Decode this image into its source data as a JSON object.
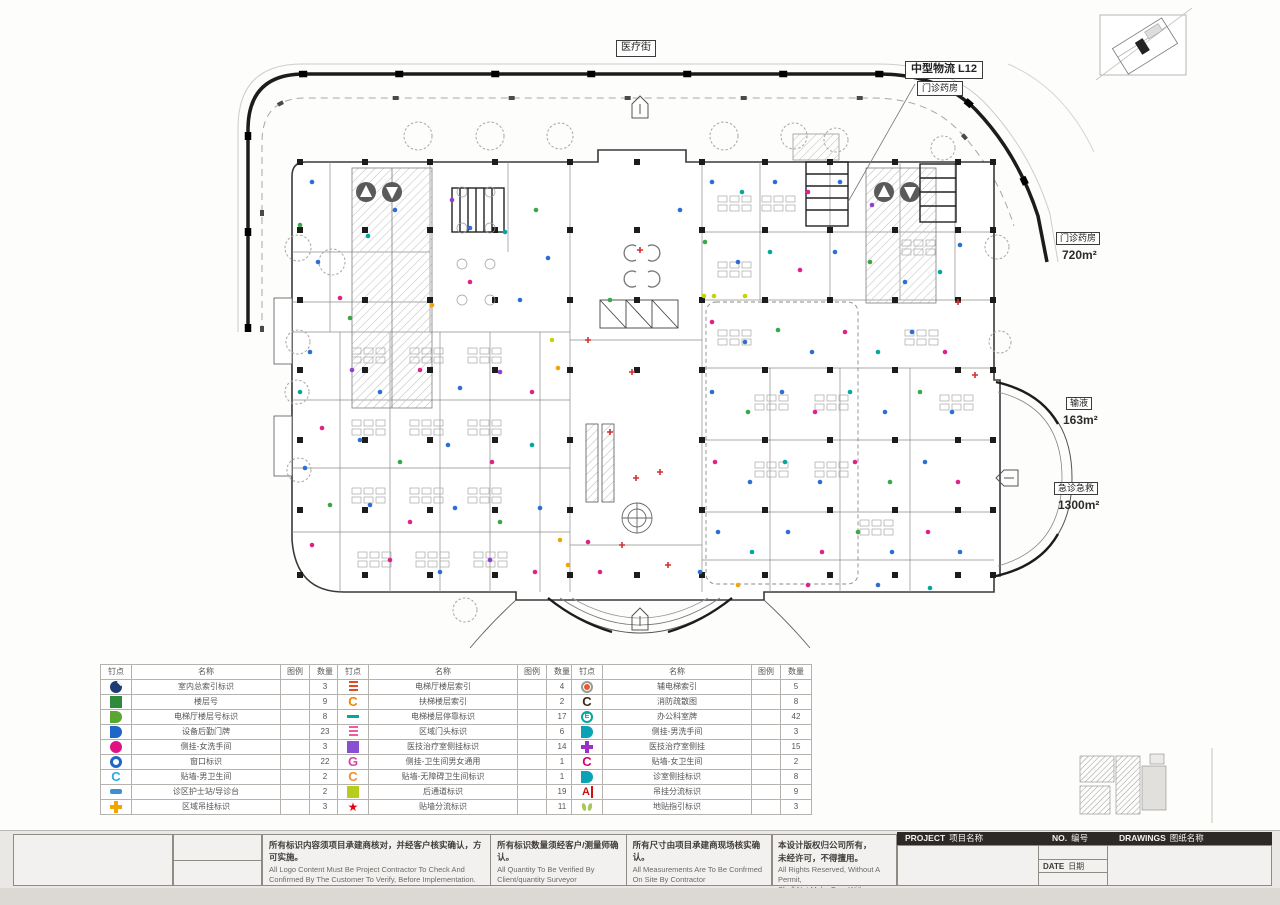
{
  "plan": {
    "street_label": "医疗街",
    "logistics_label": "中型物流  L12",
    "logistics_sub": "门诊药房",
    "area_labels": [
      {
        "name": "门诊药房",
        "area": "720m²"
      },
      {
        "name": "输液",
        "area": "163m²"
      },
      {
        "name": "急诊急救",
        "area": "1300m²"
      }
    ],
    "marker_colors": [
      "#2b6fd4",
      "#e0218a",
      "#3aa746",
      "#9040d0",
      "#d43030",
      "#f0a500",
      "#00a99d",
      "#29abe2",
      "#c3d600"
    ],
    "markers": [
      [
        312,
        182,
        0
      ],
      [
        300,
        225,
        2
      ],
      [
        318,
        262,
        0
      ],
      [
        340,
        298,
        1
      ],
      [
        368,
        236,
        6
      ],
      [
        395,
        210,
        0
      ],
      [
        452,
        200,
        3
      ],
      [
        470,
        228,
        0
      ],
      [
        505,
        232,
        6
      ],
      [
        536,
        210,
        2
      ],
      [
        548,
        258,
        0
      ],
      [
        470,
        282,
        1
      ],
      [
        432,
        305,
        5
      ],
      [
        520,
        300,
        0
      ],
      [
        350,
        318,
        2
      ],
      [
        310,
        352,
        0
      ],
      [
        300,
        392,
        6
      ],
      [
        322,
        428,
        1
      ],
      [
        305,
        468,
        0
      ],
      [
        330,
        505,
        2
      ],
      [
        312,
        545,
        1
      ],
      [
        352,
        370,
        3
      ],
      [
        380,
        392,
        0
      ],
      [
        420,
        370,
        1
      ],
      [
        460,
        388,
        0
      ],
      [
        500,
        372,
        3
      ],
      [
        532,
        392,
        1
      ],
      [
        360,
        440,
        0
      ],
      [
        400,
        462,
        2
      ],
      [
        448,
        445,
        0
      ],
      [
        492,
        462,
        1
      ],
      [
        532,
        445,
        6
      ],
      [
        370,
        505,
        0
      ],
      [
        410,
        522,
        1
      ],
      [
        455,
        508,
        0
      ],
      [
        500,
        522,
        2
      ],
      [
        540,
        508,
        0
      ],
      [
        390,
        560,
        1
      ],
      [
        440,
        572,
        0
      ],
      [
        490,
        560,
        3
      ],
      [
        535,
        572,
        1
      ],
      [
        560,
        540,
        5
      ],
      [
        558,
        368,
        5
      ],
      [
        552,
        340,
        8
      ],
      [
        588,
        340,
        4
      ],
      [
        632,
        372,
        4
      ],
      [
        610,
        432,
        4
      ],
      [
        660,
        472,
        4
      ],
      [
        588,
        542,
        1
      ],
      [
        640,
        250,
        4
      ],
      [
        680,
        210,
        0
      ],
      [
        622,
        545,
        4
      ],
      [
        636,
        478,
        4
      ],
      [
        610,
        300,
        2
      ],
      [
        704,
        296,
        8
      ],
      [
        714,
        296,
        8
      ],
      [
        745,
        296,
        8
      ],
      [
        568,
        565,
        5
      ],
      [
        600,
        572,
        1
      ],
      [
        700,
        572,
        0
      ],
      [
        668,
        565,
        4
      ],
      [
        712,
        182,
        0
      ],
      [
        742,
        192,
        6
      ],
      [
        775,
        182,
        0
      ],
      [
        808,
        192,
        1
      ],
      [
        840,
        182,
        0
      ],
      [
        872,
        205,
        3
      ],
      [
        705,
        242,
        2
      ],
      [
        738,
        262,
        0
      ],
      [
        770,
        252,
        6
      ],
      [
        800,
        270,
        1
      ],
      [
        835,
        252,
        0
      ],
      [
        870,
        262,
        2
      ],
      [
        905,
        282,
        0
      ],
      [
        940,
        272,
        6
      ],
      [
        960,
        245,
        0
      ],
      [
        712,
        322,
        1
      ],
      [
        745,
        342,
        0
      ],
      [
        778,
        330,
        2
      ],
      [
        812,
        352,
        0
      ],
      [
        845,
        332,
        1
      ],
      [
        878,
        352,
        6
      ],
      [
        912,
        332,
        0
      ],
      [
        945,
        352,
        1
      ],
      [
        712,
        392,
        0
      ],
      [
        748,
        412,
        2
      ],
      [
        782,
        392,
        0
      ],
      [
        815,
        412,
        1
      ],
      [
        850,
        392,
        6
      ],
      [
        885,
        412,
        0
      ],
      [
        920,
        392,
        2
      ],
      [
        952,
        412,
        0
      ],
      [
        715,
        462,
        1
      ],
      [
        750,
        482,
        0
      ],
      [
        785,
        462,
        6
      ],
      [
        820,
        482,
        0
      ],
      [
        855,
        462,
        1
      ],
      [
        890,
        482,
        2
      ],
      [
        925,
        462,
        0
      ],
      [
        958,
        482,
        1
      ],
      [
        718,
        532,
        0
      ],
      [
        752,
        552,
        6
      ],
      [
        788,
        532,
        0
      ],
      [
        822,
        552,
        1
      ],
      [
        858,
        532,
        2
      ],
      [
        892,
        552,
        0
      ],
      [
        928,
        532,
        1
      ],
      [
        960,
        552,
        0
      ],
      [
        738,
        585,
        5
      ],
      [
        808,
        585,
        1
      ],
      [
        878,
        585,
        0
      ],
      [
        930,
        588,
        6
      ],
      [
        975,
        375,
        4
      ],
      [
        958,
        302,
        4
      ]
    ]
  },
  "legend_tables": [
    {
      "headers": [
        "钉点",
        "名称",
        "图例",
        "数量"
      ],
      "rows": [
        {
          "icon": {
            "type": "nav",
            "color": "#1f3b73"
          },
          "name": "室内总索引标识",
          "qty": "3"
        },
        {
          "icon": {
            "type": "square",
            "color": "#2e8b3c"
          },
          "name": "楼层号",
          "qty": "9"
        },
        {
          "icon": {
            "type": "halfD",
            "color": "#5aa632"
          },
          "name": "电梯厅楼层号标识",
          "qty": "8"
        },
        {
          "icon": {
            "type": "halfD",
            "color": "#1e66c8"
          },
          "name": "设备后勤门牌",
          "qty": "23"
        },
        {
          "icon": {
            "type": "circle",
            "color": "#e01283"
          },
          "name": "侧挂-女洗手间",
          "qty": "3"
        },
        {
          "icon": {
            "type": "ring",
            "color": "#1e66c8"
          },
          "name": "窗口标识",
          "qty": "22"
        },
        {
          "icon": {
            "type": "C",
            "color": "#2da9e1"
          },
          "name": "贴墙-男卫生间",
          "qty": "2"
        },
        {
          "icon": {
            "type": "bar",
            "color": "#3f8fd2"
          },
          "name": "诊区护士站/导诊台",
          "qty": "2"
        },
        {
          "icon": {
            "type": "plus",
            "color": "#f0a500"
          },
          "name": "区域吊挂标识",
          "qty": "3"
        }
      ]
    },
    {
      "headers": [
        "钉点",
        "名称",
        "图例",
        "数量"
      ],
      "rows": [
        {
          "icon": {
            "type": "stripes",
            "color": "#e8491d"
          },
          "name": "电梯厅楼层索引",
          "qty": "4"
        },
        {
          "icon": {
            "type": "C",
            "color": "#f08300"
          },
          "name": "扶梯楼层索引",
          "qty": "2"
        },
        {
          "icon": {
            "type": "dash",
            "color": "#00a99d"
          },
          "name": "电梯楼层停靠标识",
          "qty": "17"
        },
        {
          "icon": {
            "type": "stripes",
            "color": "#f05aa0"
          },
          "name": "区域门头标识",
          "qty": "6"
        },
        {
          "icon": {
            "type": "square",
            "color": "#8a4fd0"
          },
          "name": "医技治疗室侧挂标识",
          "qty": "14"
        },
        {
          "icon": {
            "type": "G",
            "color": "#d6489c"
          },
          "name": "侧挂-卫生间男女通用",
          "qty": "1"
        },
        {
          "icon": {
            "type": "C",
            "color": "#f09030"
          },
          "name": "贴墙-无障碍卫生间标识",
          "qty": "1"
        },
        {
          "icon": {
            "type": "square",
            "color": "#b8cc1e"
          },
          "name": "后通道标识",
          "qty": "19"
        },
        {
          "icon": {
            "type": "star",
            "color": "#e60012"
          },
          "name": "贴墙分流标识",
          "qty": "11"
        }
      ]
    },
    {
      "headers": [
        "钉点",
        "名称",
        "图例",
        "数量"
      ],
      "rows": [
        {
          "icon": {
            "type": "target",
            "color": "#e85a2a"
          },
          "name": "辅电梯索引",
          "qty": "5"
        },
        {
          "icon": {
            "type": "C",
            "color": "#3a2a1a"
          },
          "name": "消防疏散图",
          "qty": "8"
        },
        {
          "icon": {
            "type": "Ering",
            "color": "#00a99d"
          },
          "name": "办公科室牌",
          "qty": "42"
        },
        {
          "icon": {
            "type": "halfD",
            "color": "#0aa3b5"
          },
          "name": "侧挂-男洗手间",
          "qty": "3"
        },
        {
          "icon": {
            "type": "plus",
            "color": "#9b30c8"
          },
          "name": "医技治疗室侧挂",
          "qty": "15"
        },
        {
          "icon": {
            "type": "C",
            "color": "#d6006e"
          },
          "name": "贴墙-女卫生间",
          "qty": "2"
        },
        {
          "icon": {
            "type": "halfD",
            "color": "#0aa3b5"
          },
          "name": "诊室侧挂标识",
          "qty": "8"
        },
        {
          "icon": {
            "type": "Abar",
            "color": "#cc1111"
          },
          "name": "吊挂分流标识",
          "qty": "9"
        },
        {
          "icon": {
            "type": "feet",
            "color": "#a8c85a"
          },
          "name": "地贴指引标识",
          "qty": "3"
        }
      ]
    }
  ],
  "titleblock": {
    "notes": [
      {
        "cn": "所有标识内容须项目承建商核对，并经客户核实确认，方可实施。",
        "en": "All Logo Content Must Be Project Contractor To Check And Confirmed By The Customer To Verify, Before Implementation."
      },
      {
        "cn": "所有标识数量须经客户/测量师确认。",
        "en": "All Quantity To Be Verified By Client/quantity Surveyor"
      },
      {
        "cn": "所有尺寸由项目承建商现场核实确认。",
        "en": "All Measurements Are To Be Confrmed On Site By Contractor"
      }
    ],
    "copyright_cn1": "本设计版权归公司所有，",
    "copyright_cn2": "未经许可，不得擅用。",
    "copyright_en1": "All Rights Reserved, Without A Permit,",
    "copyright_en2": "Shall Not Make Free With",
    "project_label": "PROJECT",
    "project_cn": "项目名称",
    "no_label": "NO.",
    "no_cn": "编号",
    "drawings_label": "DRAWINGS",
    "drawings_cn": "图纸名称",
    "date_label": "DATE",
    "date_cn": "日期"
  }
}
